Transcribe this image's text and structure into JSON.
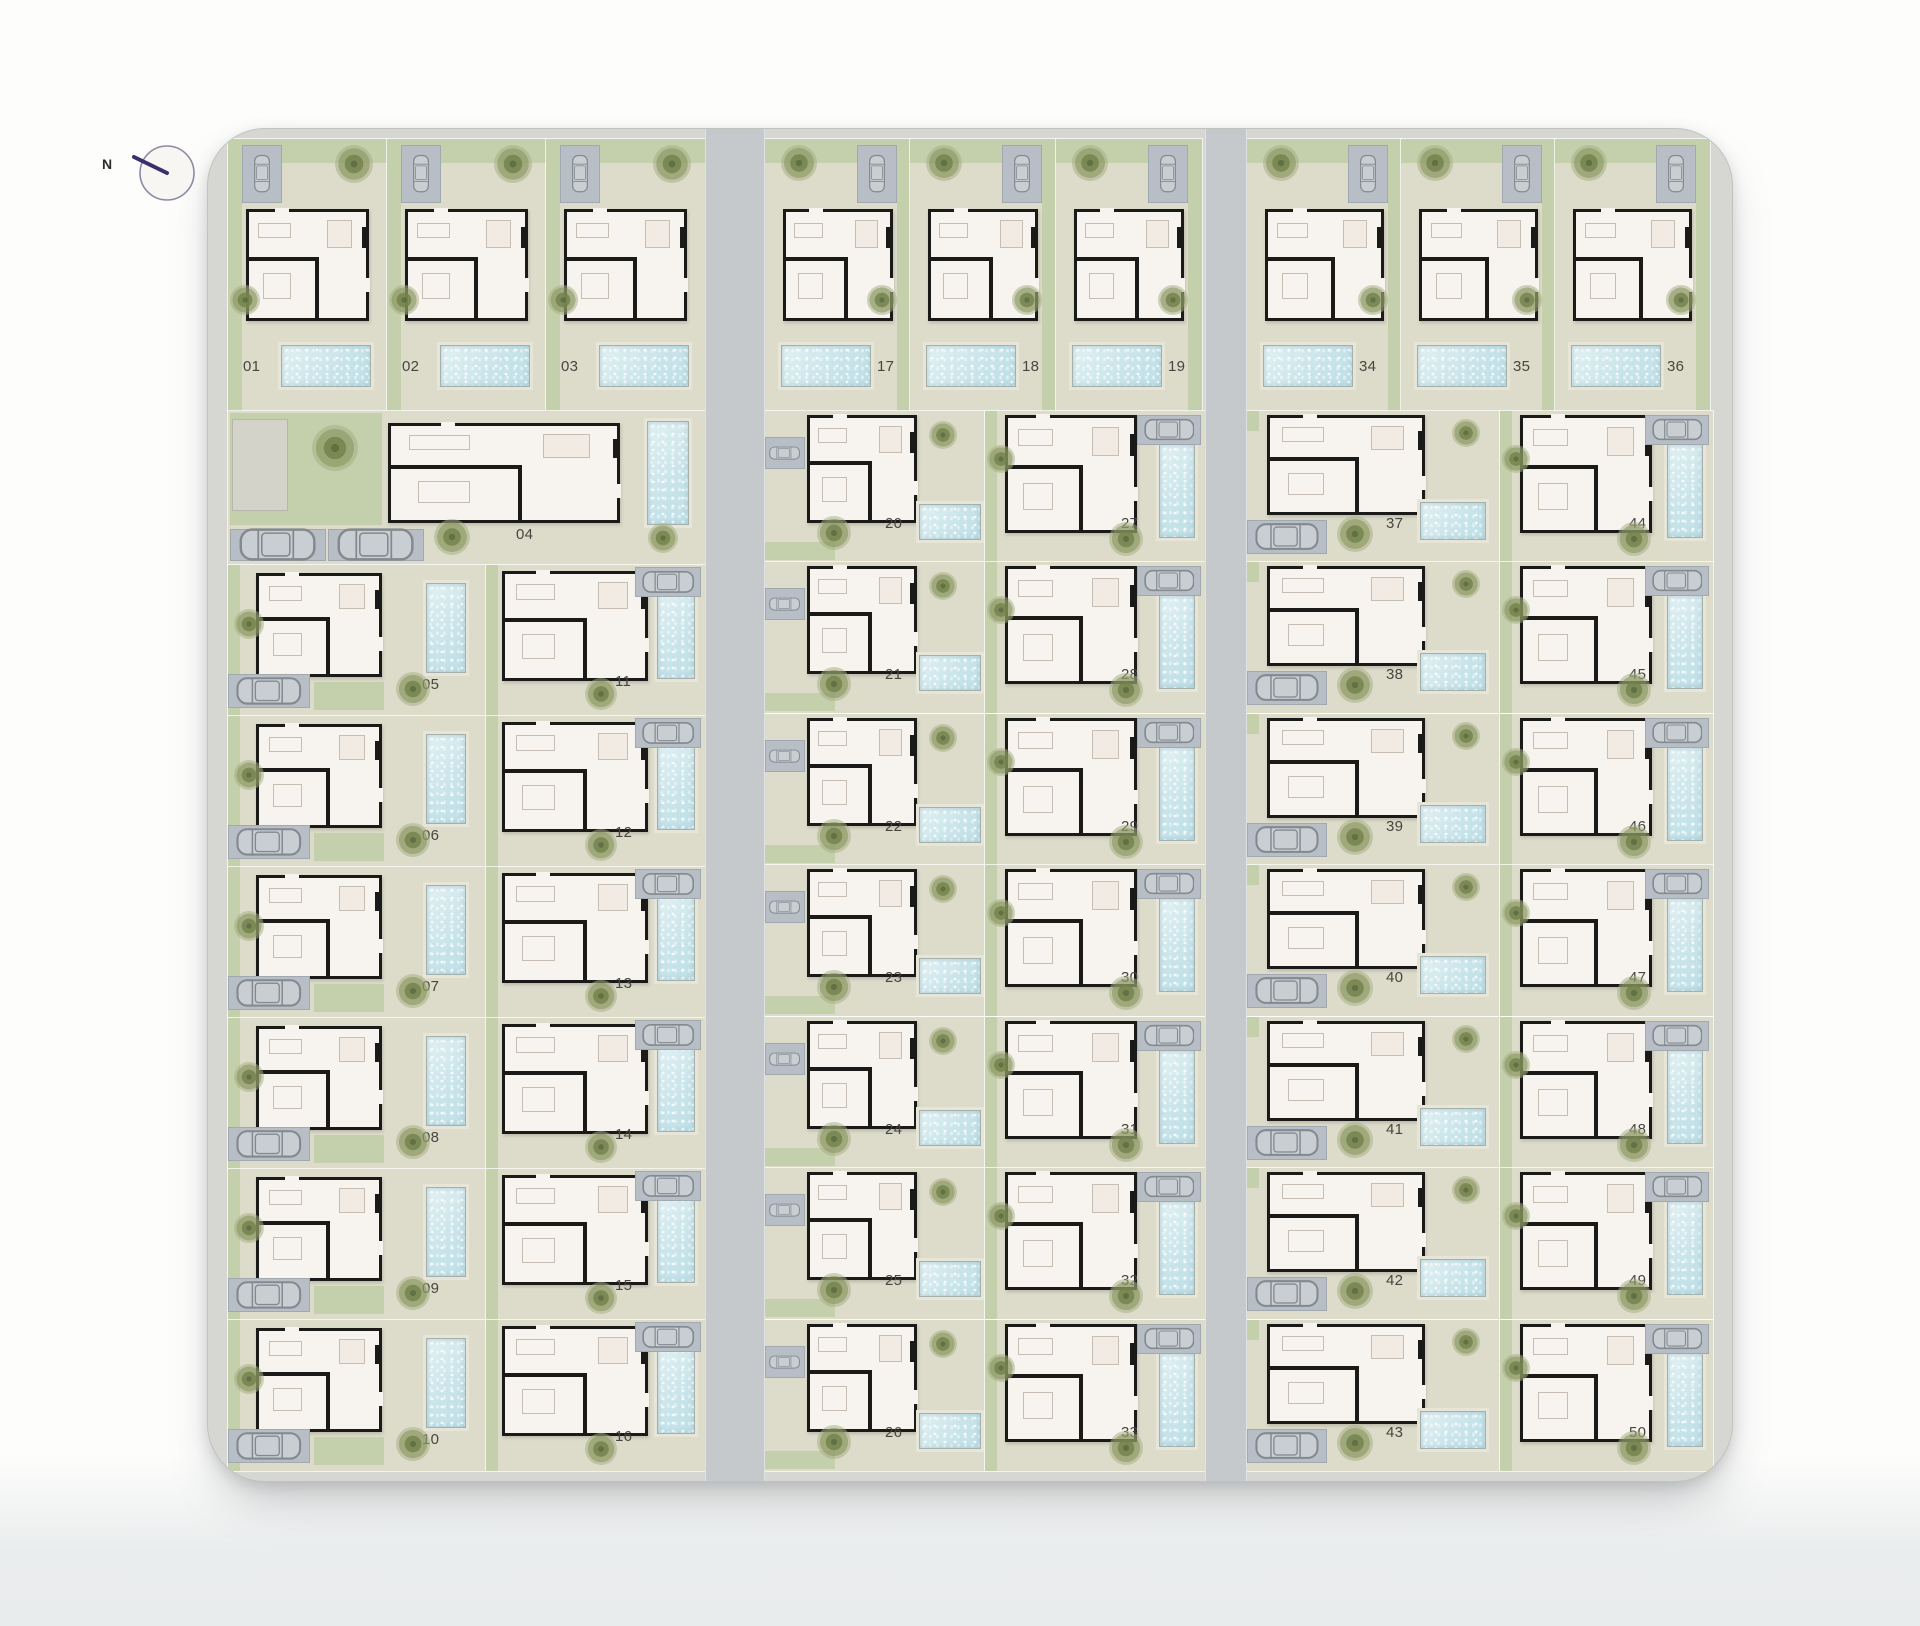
{
  "compass": {
    "label": "N"
  },
  "site": {
    "blocks": [
      {
        "id": "left",
        "top_row": {
          "plots": [
            "01",
            "02",
            "03"
          ]
        },
        "wide_plot": {
          "number": "04"
        },
        "columns": [
          {
            "id": "A",
            "plots": [
              "05",
              "06",
              "07",
              "08",
              "09",
              "10"
            ]
          },
          {
            "id": "B",
            "plots": [
              "11",
              "12",
              "13",
              "14",
              "15",
              "16"
            ]
          }
        ]
      },
      {
        "id": "middle",
        "top_row": {
          "plots": [
            "17",
            "18",
            "19"
          ]
        },
        "columns": [
          {
            "id": "A",
            "plots": [
              "20",
              "21",
              "22",
              "23",
              "24",
              "25",
              "26"
            ]
          },
          {
            "id": "B",
            "plots": [
              "27",
              "28",
              "29",
              "30",
              "31",
              "32",
              "33"
            ]
          }
        ]
      },
      {
        "id": "right",
        "top_row": {
          "plots": [
            "34",
            "35",
            "36"
          ]
        },
        "columns": [
          {
            "id": "A",
            "plots": [
              "37",
              "38",
              "39",
              "40",
              "41",
              "42",
              "43"
            ]
          },
          {
            "id": "B",
            "plots": [
              "44",
              "45",
              "46",
              "47",
              "48",
              "49",
              "50"
            ]
          }
        ]
      }
    ]
  },
  "colors": {
    "road": "#c6c9cb",
    "pavement": "#d6d7d2",
    "garden": "#c4cfab",
    "patio": "#dddcca",
    "pool": "#cde6ea",
    "house_fill": "#f7f3ee",
    "wall": "#1a1a18",
    "driveway": "#b7bec5",
    "tree": "#7f8d58",
    "label": "#46453f",
    "shed": "#d3d3ca",
    "compass_needle": "#392f6d",
    "compass_ring": "#8f89a6"
  }
}
